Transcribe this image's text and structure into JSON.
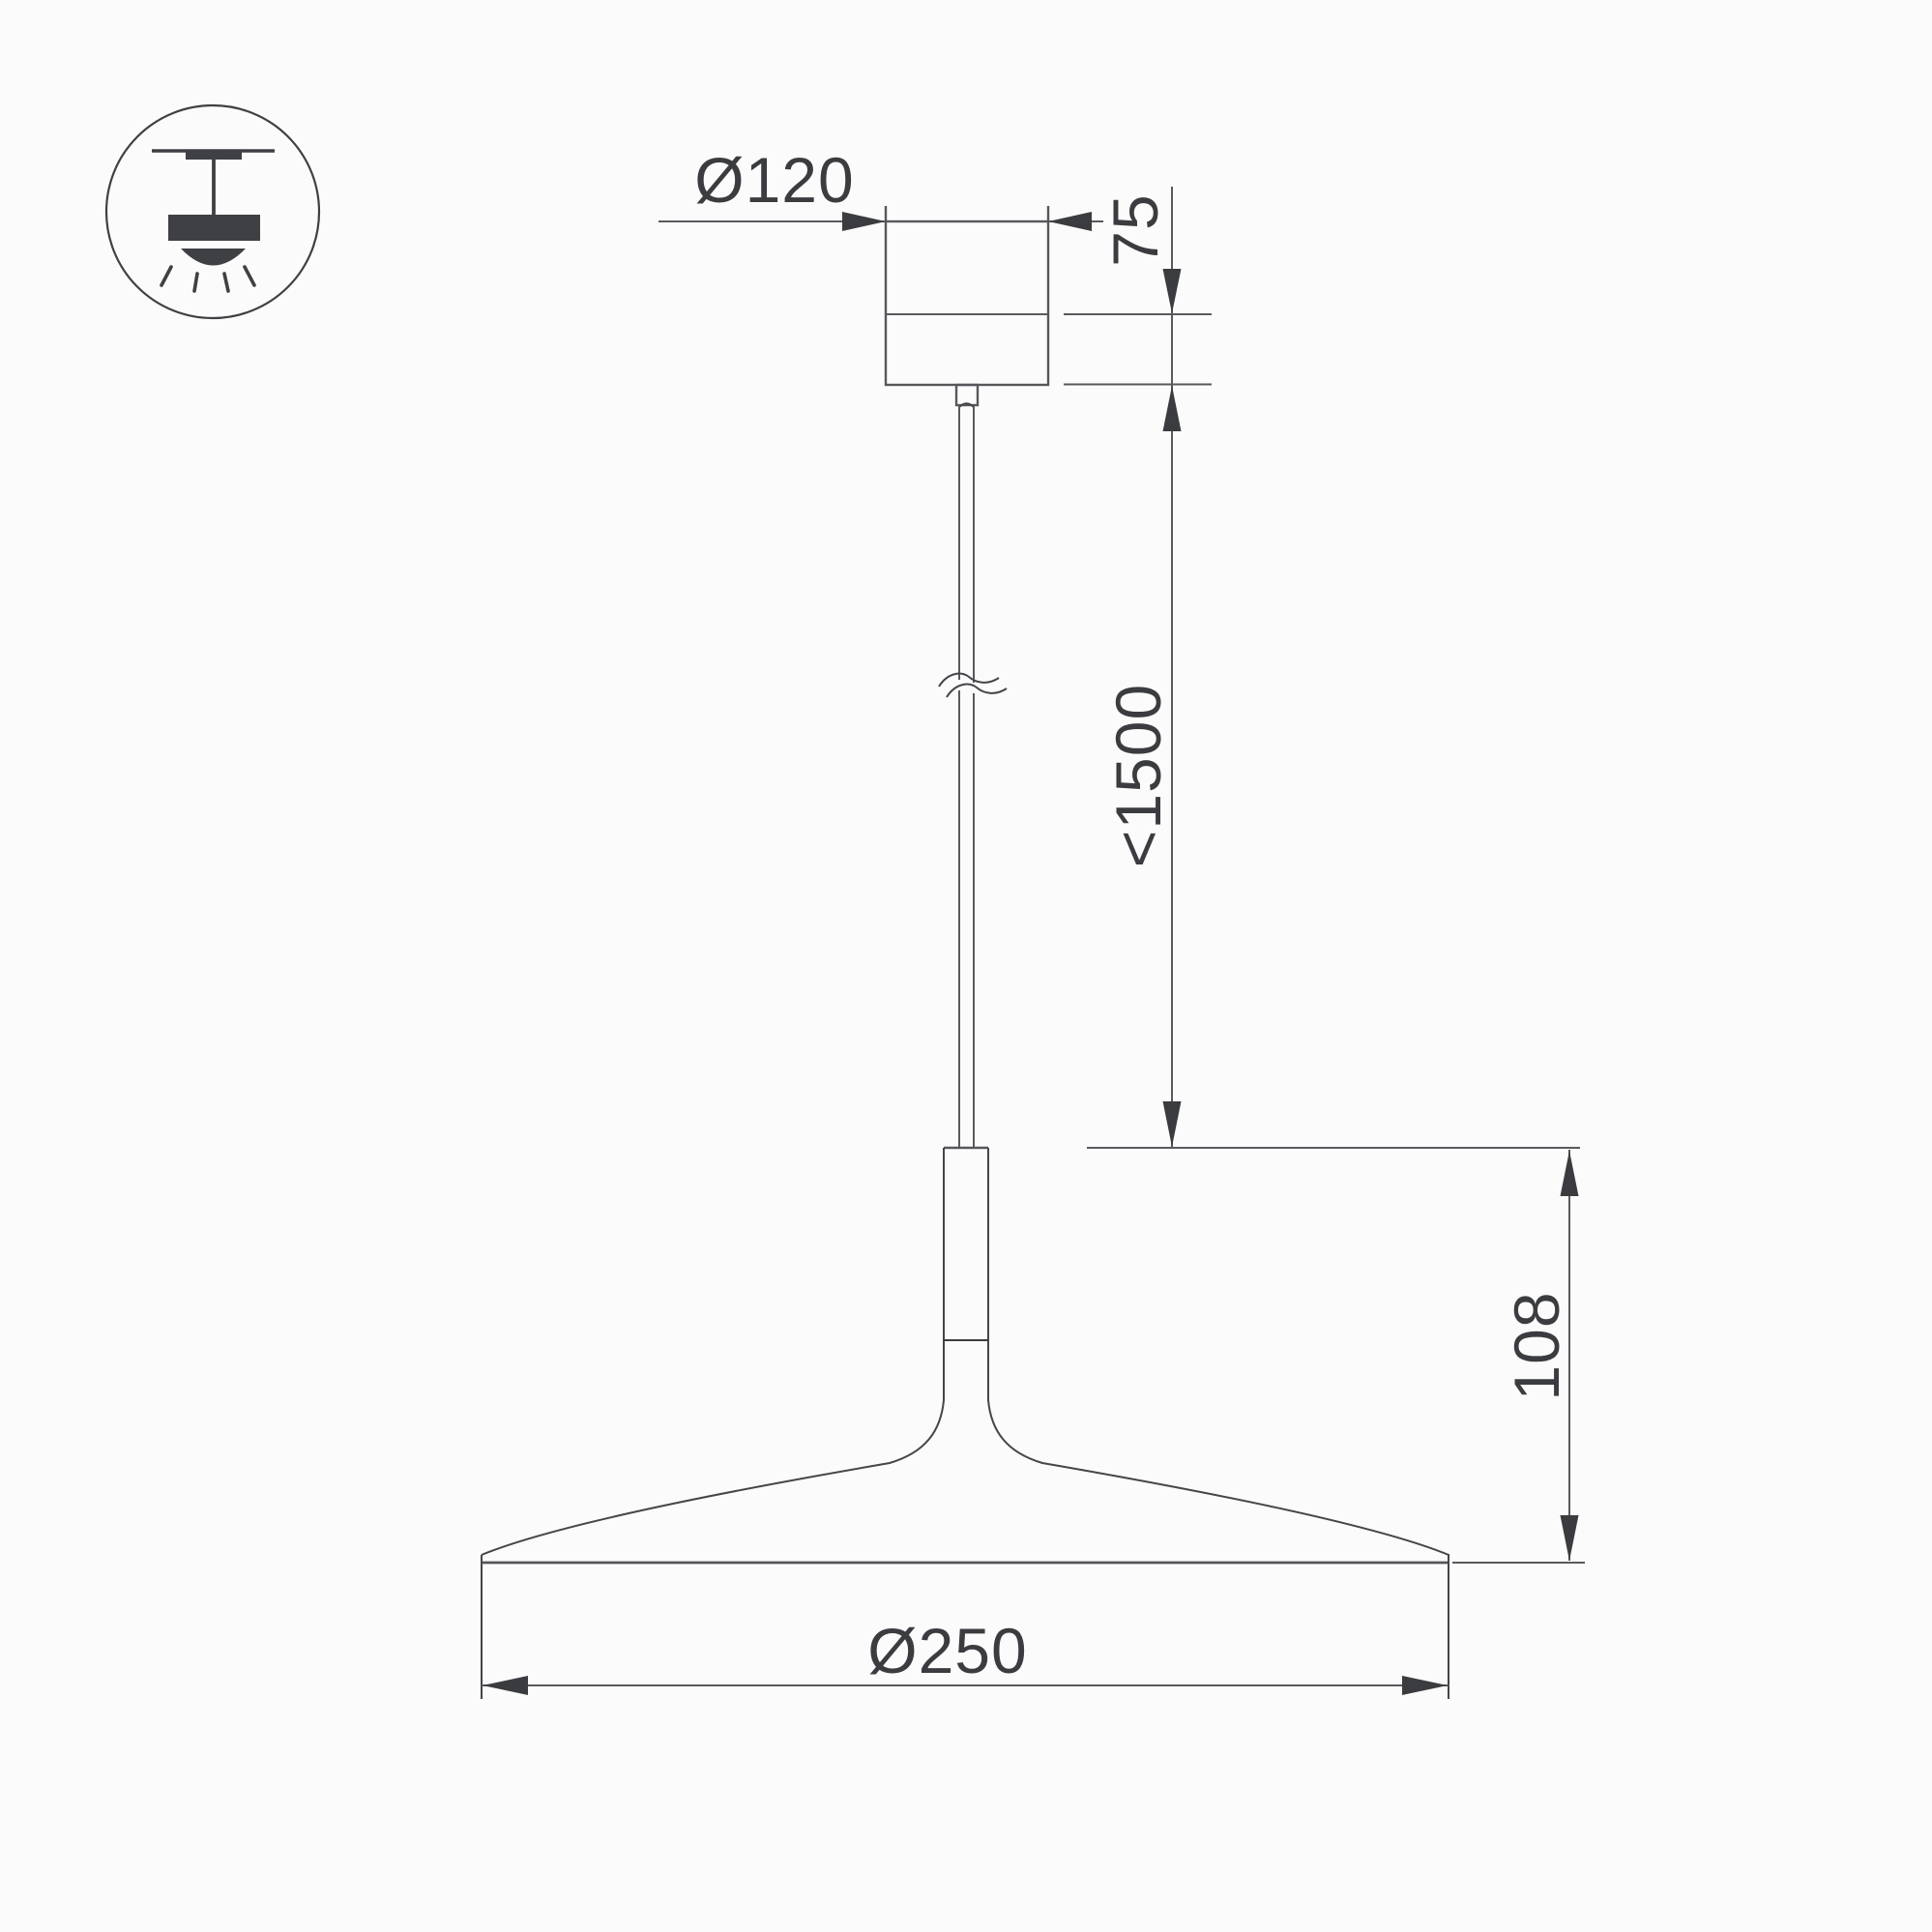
{
  "page": {
    "background": "#fbfbfb",
    "type": "technical-dimension-drawing",
    "subject": "pendant-lamp"
  },
  "palette": {
    "line_gray": "#595a5e",
    "dark": "#3b3c40",
    "curve": "#45464a"
  },
  "icon": {
    "name": "pendant-lamp-ceiling-mount-icon"
  },
  "labels": {
    "canopy_diameter": "Ø120",
    "canopy_height": "75",
    "suspension_length": "<1500",
    "shade_height": "108",
    "shade_diameter": "Ø250"
  }
}
